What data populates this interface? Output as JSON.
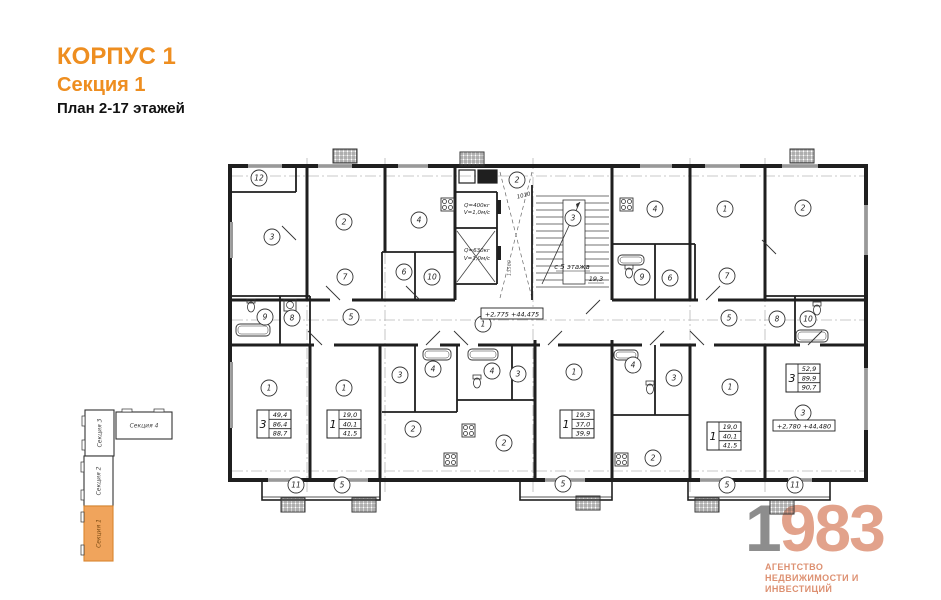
{
  "header": {
    "building": "КОРПУС 1",
    "section": "Секция 1",
    "plan": "План 2-17 этажей"
  },
  "colors": {
    "accent_orange": "#EE8E20",
    "minimap_highlight": "#F0A45C",
    "logo_gray": "#8D8D8D",
    "logo_salmon": "#E2A28B",
    "logo_subtitle": "#DD9071",
    "wall": "#1F1F1F"
  },
  "minimap": {
    "sections": [
      {
        "label": "Секция 4",
        "x": 116,
        "y": 412,
        "w": 56,
        "h": 27,
        "vertical": false,
        "highlight": false
      },
      {
        "label": "Секция 3",
        "x": 85,
        "y": 410,
        "w": 29,
        "h": 46,
        "vertical": true,
        "highlight": false
      },
      {
        "label": "Секция 2",
        "x": 84,
        "y": 456,
        "w": 29,
        "h": 50,
        "vertical": true,
        "highlight": false
      },
      {
        "label": "Секция 1",
        "x": 84,
        "y": 506,
        "w": 29,
        "h": 55,
        "vertical": true,
        "highlight": true
      }
    ]
  },
  "plan": {
    "room_markers": [
      {
        "n": "12",
        "x": 259,
        "y": 178
      },
      {
        "n": "3",
        "x": 272,
        "y": 237
      },
      {
        "n": "2",
        "x": 344,
        "y": 222
      },
      {
        "n": "4",
        "x": 419,
        "y": 220
      },
      {
        "n": "7",
        "x": 345,
        "y": 277
      },
      {
        "n": "6",
        "x": 404,
        "y": 272
      },
      {
        "n": "10",
        "x": 432,
        "y": 277
      },
      {
        "n": "9",
        "x": 265,
        "y": 317
      },
      {
        "n": "8",
        "x": 292,
        "y": 318
      },
      {
        "n": "5",
        "x": 351,
        "y": 317
      },
      {
        "n": "2",
        "x": 517,
        "y": 180
      },
      {
        "n": "3",
        "x": 573,
        "y": 218
      },
      {
        "n": "4",
        "x": 655,
        "y": 209
      },
      {
        "n": "1",
        "x": 725,
        "y": 209
      },
      {
        "n": "2",
        "x": 803,
        "y": 208
      },
      {
        "n": "9",
        "x": 642,
        "y": 277
      },
      {
        "n": "6",
        "x": 670,
        "y": 278
      },
      {
        "n": "7",
        "x": 727,
        "y": 276
      },
      {
        "n": "5",
        "x": 729,
        "y": 318
      },
      {
        "n": "8",
        "x": 777,
        "y": 319
      },
      {
        "n": "10",
        "x": 808,
        "y": 319
      },
      {
        "n": "1",
        "x": 483,
        "y": 324
      },
      {
        "n": "1",
        "x": 269,
        "y": 388
      },
      {
        "n": "1",
        "x": 344,
        "y": 388
      },
      {
        "n": "3",
        "x": 400,
        "y": 375
      },
      {
        "n": "4",
        "x": 433,
        "y": 369
      },
      {
        "n": "4",
        "x": 492,
        "y": 371
      },
      {
        "n": "3",
        "x": 518,
        "y": 374
      },
      {
        "n": "1",
        "x": 574,
        "y": 372
      },
      {
        "n": "2",
        "x": 413,
        "y": 429
      },
      {
        "n": "2",
        "x": 504,
        "y": 443
      },
      {
        "n": "4",
        "x": 633,
        "y": 365
      },
      {
        "n": "3",
        "x": 674,
        "y": 378
      },
      {
        "n": "2",
        "x": 653,
        "y": 458
      },
      {
        "n": "1",
        "x": 730,
        "y": 387
      },
      {
        "n": "3",
        "x": 803,
        "y": 413
      },
      {
        "n": "11",
        "x": 296,
        "y": 485
      },
      {
        "n": "5",
        "x": 342,
        "y": 485
      },
      {
        "n": "5",
        "x": 563,
        "y": 484
      },
      {
        "n": "5",
        "x": 727,
        "y": 485
      },
      {
        "n": "11",
        "x": 795,
        "y": 485
      }
    ],
    "apartment_tables": [
      {
        "x": 257,
        "y": 410,
        "rooms": "3",
        "values": [
          "49,4",
          "86,4",
          "88,7"
        ]
      },
      {
        "x": 327,
        "y": 410,
        "rooms": "1",
        "values": [
          "19,0",
          "40,1",
          "41,5"
        ]
      },
      {
        "x": 560,
        "y": 410,
        "rooms": "1",
        "values": [
          "19,3",
          "37,0",
          "39,9"
        ]
      },
      {
        "x": 707,
        "y": 422,
        "rooms": "1",
        "values": [
          "19,0",
          "40,1",
          "41,5"
        ]
      },
      {
        "x": 786,
        "y": 364,
        "rooms": "3",
        "values": [
          "52,9",
          "89,9",
          "90,7"
        ]
      }
    ],
    "elevation_marks": [
      {
        "text": "+2,775  +44,475",
        "x": 512,
        "y": 314
      },
      {
        "text": "+2,780  +44,480",
        "x": 804,
        "y": 426
      }
    ],
    "labels": {
      "elevator1_line1": "Q=400кг",
      "elevator1_line2": "V=1,0м/с",
      "elevator2_line1": "Q=630кг",
      "elevator2_line2": "V=1,0м/с",
      "stair_from": "с 5 этажа",
      "stair_area": "19,3",
      "dim1": "1010",
      "dim2": "13560"
    }
  },
  "logo": {
    "digit": "1",
    "rest": "983",
    "line1": "АГЕНТСТВО",
    "line2": "НЕДВИЖИМОСТИ И ИНВЕСТИЦИЙ"
  }
}
